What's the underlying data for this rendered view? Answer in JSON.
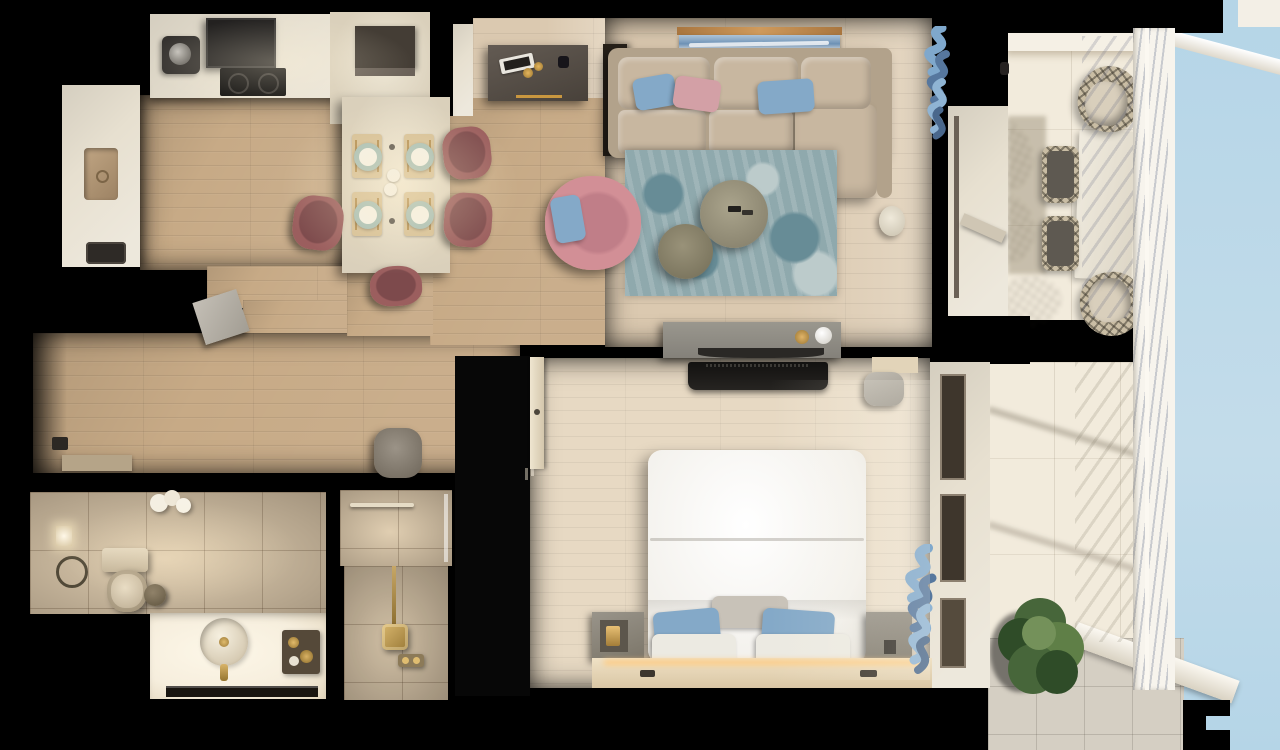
{
  "meta": {
    "scene": "apartment-3d-floor-plan-top-down-render",
    "view": "top-down",
    "width_px": 1280,
    "height_px": 750
  },
  "palette": {
    "bg": "#000000",
    "woodKitchen": "#c7aa86",
    "woodLiving": "#dbc9b0",
    "woodBedroom": "#e7d9c3",
    "counter": "#e7e0d0",
    "stoneIsland": "#dad0bb",
    "hood": "#232120",
    "cooktop": "#121110",
    "applianceDark": "#443d35",
    "applianceFace": "#6b6259",
    "sinkBasin": "#b29878",
    "sideboard": "#574f48",
    "sideboardGold": "#c9973f",
    "wallStub": "#262019",
    "artFrame": "#b8834d",
    "artSea": "#6f94b8",
    "artSky": "#aec3d6",
    "artFoam": "#edf1f4",
    "sofa": "#c8b7a0",
    "sofaShade": "#b2a28b",
    "pillowBlue": "#84a9c8",
    "pillowPink": "#d3a0a6",
    "rugBase": "#8fa9ad",
    "rugDark": "#678c96",
    "rugLight": "#bccbcb",
    "tableBig": "#a19b84",
    "tableSmall": "#8d8873",
    "armchairPink": "#d28f96",
    "armchairDeep": "#c07e88",
    "curtainBlue": "#7fa8cc",
    "curtainBlueDeep": "#56779e",
    "chairMauve": "#9b5e5e",
    "chairMauveDark": "#7d4a4c",
    "placemat": "#d5bf95",
    "plateRim": "#a6beb5",
    "cutleryGold": "#a9813f",
    "bedWhite": "#f3f1ec",
    "pillowGray": "#c8c2b8",
    "pillowWhite": "#eceae2",
    "nightstand": "#8b857b",
    "benchCream": "#ead9bc",
    "glowAmber": "#ffca7e",
    "tvDark": "#1b1a18",
    "consoleGray": "#8f8c83",
    "wardrobe": "#070707",
    "doorCream": "#e4d9c4",
    "bathTile": "#ccb89c",
    "bathBright": "#f6eedd",
    "porcelain": "#dbcfb8",
    "brass": "#b4925a",
    "mirrorDark": "#191510",
    "balconyFloor": "#f2ebdc",
    "balconyGray": "#d5cfc3",
    "outdoorTable": "#e9e3d6",
    "weave": "#c9bda4",
    "weaveSeat": "#5e5951",
    "railWhite": "#f7f4ed",
    "sky": "#b5d5e7",
    "plantGreen": "#47663a",
    "plantGreenLight": "#5f7f47",
    "plantGreenDark": "#2f4c28",
    "poufTaupe": "#8c8478",
    "threshold": "#b5a488",
    "binTaupe": "#b2ada4"
  },
  "rooms": {
    "kitchen": {
      "objects": [
        "counter",
        "range-hood",
        "cooktop",
        "coffee-machine",
        "island-appliance-box",
        "sink",
        "toaster"
      ]
    },
    "dining": {
      "objects": [
        "stone-dining-table",
        "place-setting-x4",
        "mauve-chair-x4",
        "serving-cups"
      ]
    },
    "living": {
      "objects": [
        "sideboard",
        "decor-tray",
        "gold-cups",
        "wall-art",
        "sectional-sofa",
        "throw-pillow-x3",
        "area-rug",
        "coffee-table-large",
        "coffee-table-small",
        "remote-x2",
        "pink-armchair",
        "armchair-pillow",
        "side-table",
        "blue-curtain"
      ]
    },
    "hallway": {
      "objects": [
        "pouf",
        "open-door-leaf",
        "entry-threshold",
        "door-stop"
      ]
    },
    "bathroom": {
      "objects": [
        "toilet",
        "waste-bin",
        "towel-ring",
        "wall-lamp",
        "pendant-light",
        "vanity",
        "round-basin",
        "brass-faucet",
        "amenity-tray",
        "mirror",
        "shower",
        "brass-shower-head",
        "shower-controls"
      ]
    },
    "bedroom": {
      "objects": [
        "tv-console",
        "soundbar",
        "decor-bowl",
        "decor-sphere",
        "tv",
        "double-bed",
        "pillow-gray",
        "pillow-blue-x2",
        "pillow-white-x2",
        "nightstand-left",
        "nightstand-lamp",
        "nightstand-right",
        "bench-led",
        "wardrobe",
        "door-leaf",
        "blue-curtain",
        "basket",
        "threshold-mat"
      ]
    },
    "balcony": {
      "objects": [
        "parapet",
        "outdoor-table",
        "woven-side-chair-x2",
        "woven-lounge-chair-x2",
        "chair-shadow-lattice",
        "slatted-railing",
        "plant",
        "gray-tile-deck",
        "sky"
      ]
    }
  }
}
